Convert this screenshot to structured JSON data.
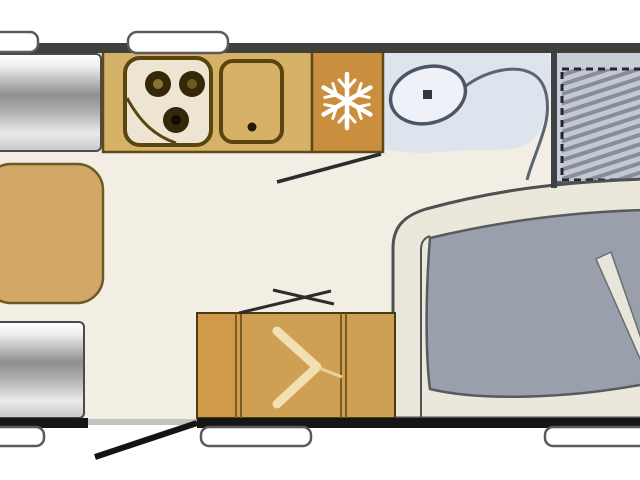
{
  "diagram": {
    "kind": "caravan-floorplan",
    "orientation": "side-view-top-down",
    "rooms": {
      "front_dinette": {
        "items": [
          "bench-seat-front",
          "dinette-table",
          "bench-seat-rear"
        ]
      },
      "kitchen": {
        "items": [
          "hob-three-burner",
          "sink-with-drain",
          "refrigerator-snowflake"
        ]
      },
      "washroom": {
        "items": [
          "toilet"
        ],
        "partition": "curved-wall"
      },
      "bedroom": {
        "items": [
          "bunk-bed-hatched-dashed"
        ]
      },
      "rear_lounge": {
        "items": [
          "corner-sofa-gray-cushion",
          "cushion-divider-band"
        ]
      },
      "storage": {
        "items": [
          "wardrobe-chevron",
          "side-cabinet"
        ]
      }
    },
    "openings": {
      "entrance_door": "bottom-wall-open-swing",
      "interior_door_marks": 2,
      "windows_top_wall": 2,
      "windows_bottom_wall": 3
    }
  },
  "colors": {
    "background": "#ffffff",
    "wall_top": "#403f3a",
    "wall_bottom": "#161616",
    "wall_bed": "#3c4148",
    "floor": "#f3eee3",
    "bathroom_floor": "#dee4ee",
    "bed_floor": "#c9cdd8",
    "counter": "#d6b269",
    "counter_border": "#5f4a17",
    "hob_face": "#ede5d1",
    "burner": "#35270a",
    "fridge": "#c98e3e",
    "snowflake": "#ffffff",
    "table": "#d3a765",
    "table_border": "#6e5826",
    "cabinet": "#cfa054",
    "cabinet_left": "#d09a4a",
    "cabinet_border": "#4a3a12",
    "chevron": "#f2dfb2",
    "lounge_base": "#ebe7db",
    "cushion": "#99a0ab",
    "cushion_band": "#e8e5da",
    "toilet_fill": "#eef1f7",
    "toilet_outline": "#4d5664",
    "partition_curve": "#5a6472",
    "window_fill": "#ffffff",
    "window_border": "#55555",
    "door_line": "#141414",
    "threshold": "#c2c2c2"
  }
}
